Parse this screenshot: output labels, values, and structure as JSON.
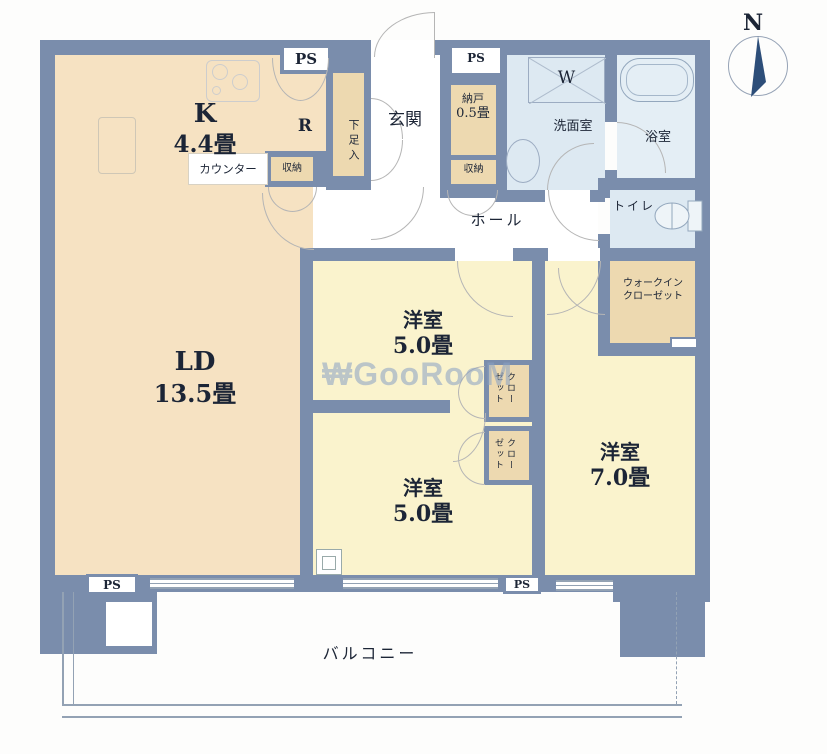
{
  "colors": {
    "wall": "#7a8dac",
    "peach": "#f6e2c2",
    "tan": "#edd9b0",
    "yellow": "#faf3cd",
    "blue": "#dde9f2",
    "bathblue": "#e4eef5",
    "line": "#b5b5b5",
    "balcline": "#93a2b4",
    "label": "#1c2536",
    "watermark": "#89a1c5"
  },
  "compass": {
    "north_label": "N"
  },
  "watermark": {
    "text": "₩GooRooM"
  },
  "ps": {
    "top_left": "PS",
    "top_center": "PS",
    "bottom_left": "PS",
    "bottom_center": "PS"
  },
  "rooms": {
    "kitchen": {
      "name": "K",
      "size": "4.4畳"
    },
    "refrigerator_space": {
      "label": "R"
    },
    "counter": {
      "label": "カウンター"
    },
    "kitchen_storage": {
      "label": "収納"
    },
    "shoe_closet": {
      "label": "下足入"
    },
    "entrance": {
      "label": "玄関"
    },
    "storeroom": {
      "name": "納戸",
      "size": "0.5畳"
    },
    "hall_storage": {
      "label": "収納"
    },
    "washer": {
      "label": "W"
    },
    "washroom": {
      "label": "洗面室"
    },
    "bathroom": {
      "label": "浴室"
    },
    "toilet": {
      "label": "トイレ"
    },
    "hall": {
      "label": "ホール"
    },
    "walk_in_closet": {
      "line1": "ウォークイン",
      "line2": "クローゼット"
    },
    "bedroom_upper": {
      "name": "洋室",
      "size": "5.0畳"
    },
    "bedroom_lower": {
      "name": "洋室",
      "size": "5.0畳"
    },
    "bedroom_right": {
      "name": "洋室",
      "size": "7.0畳"
    },
    "living_dining": {
      "name": "LD",
      "size": "13.5畳"
    },
    "closet_upper": {
      "label": "クローゼット"
    },
    "closet_lower": {
      "label": "クローゼット"
    },
    "balcony": {
      "label": "バルコニー"
    }
  }
}
